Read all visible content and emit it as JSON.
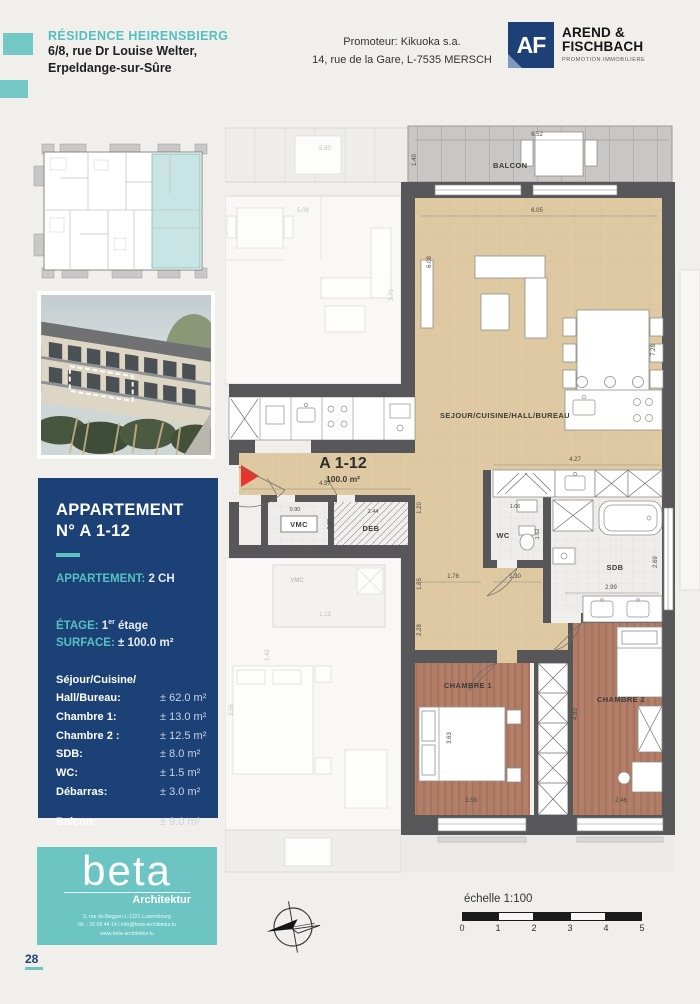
{
  "header": {
    "residence": "RÉSIDENCE HEIRENSBIERG",
    "address_line1": "6/8, rue Dr Louise Welter,",
    "address_line2": "Erpeldange-sur-Sûre",
    "promoter_line1": "Promoteur: Kikuoka s.a.",
    "promoter_line2": "14, rue de la Gare, L-7535 MERSCH",
    "agency": {
      "initials": "AF",
      "name_line1": "AREND &",
      "name_line2": "FISCHBACH",
      "tagline": "PROMOTION IMMOBILIERE"
    }
  },
  "sidebar": {
    "apartment_panel": {
      "title_line1": "APPARTEMENT",
      "title_line2": "N° A 1-12",
      "type_label": "APPARTEMENT:",
      "type_value": "2 CH",
      "floor_label": "ÉTAGE:",
      "floor_num": "1",
      "floor_sup": "er",
      "floor_rest": " étage",
      "surface_label": "SURFACE:",
      "surface_value": "± 100.0 m²",
      "rooms": [
        {
          "label": "Séjour/Cuisine/",
          "label2": "Hall/Bureau:",
          "value": "± 62.0 m²"
        },
        {
          "label": "Chambre 1:",
          "value": "± 13.0 m²"
        },
        {
          "label": "Chambre 2 :",
          "value": "± 12.5 m²"
        },
        {
          "label": "SDB:",
          "value": "± 8.0 m²"
        },
        {
          "label": "WC:",
          "value": "± 1.5 m²"
        },
        {
          "label": "Débarras:",
          "value": "± 3.0 m²"
        },
        {
          "label": "Balcon:",
          "value": "± 9.0 m²"
        }
      ]
    },
    "beta": {
      "name": "beta",
      "subtitle": "Architektur",
      "address_line1": "5, rue de Beggen L-1221 Luxembourg",
      "address_line2": "tél. : 26 09 44 14 / info@beta-architektur.lu",
      "address_line3": "www.beta-architektur.lu"
    }
  },
  "plan": {
    "labels": {
      "balcon": "BALCON",
      "sejour": "SEJOUR/CUISINE/HALL/BUREAU",
      "unit_no": "A 1-12",
      "unit_area": "100.0 m²",
      "vmc": "VMC",
      "deb": "DEB",
      "wc": "WC",
      "sdb": "SDB",
      "chambre1": "CHAMBRE 1",
      "chambre2": "CHAMBRE 2",
      "vmc_neighbor": "VMC"
    },
    "dims": {
      "balcony_width": "6.52",
      "balcony_depth": "1.40",
      "living_width": "6.05",
      "living_height_left": "6.08",
      "living_height_right": "7.28",
      "kitchen_row": "4.27",
      "hall_width": "4.57",
      "vmc_width": "0.90",
      "deb_width": "2.44",
      "deb_depth": "0.86",
      "corridor_1": "1.20",
      "corridor_2": "1.85",
      "wc_width": "1.06",
      "wc_depth": "1.62",
      "passage_1": "1.78",
      "passage_2": "1.30",
      "passage_3": "2.28",
      "sdb_width": "2.99",
      "sdb_depth": "2.69",
      "ch1_height": "3.63",
      "ch1_width": "3.58",
      "ch2_height": "4.83",
      "ch2_width": "2.46",
      "neighbor_balcony": "5.80",
      "neighbor_living": "5.08",
      "neighbor_depth": "3.71",
      "neighbor_width": "4.97",
      "neighbor_1": "1.13",
      "neighbor_2": "3.56",
      "neighbor_3": "1.42"
    }
  },
  "footer": {
    "page_number": "28",
    "scale_label": "échelle 1:100",
    "scale_ticks": [
      "0",
      "1",
      "2",
      "3",
      "4",
      "5"
    ]
  }
}
